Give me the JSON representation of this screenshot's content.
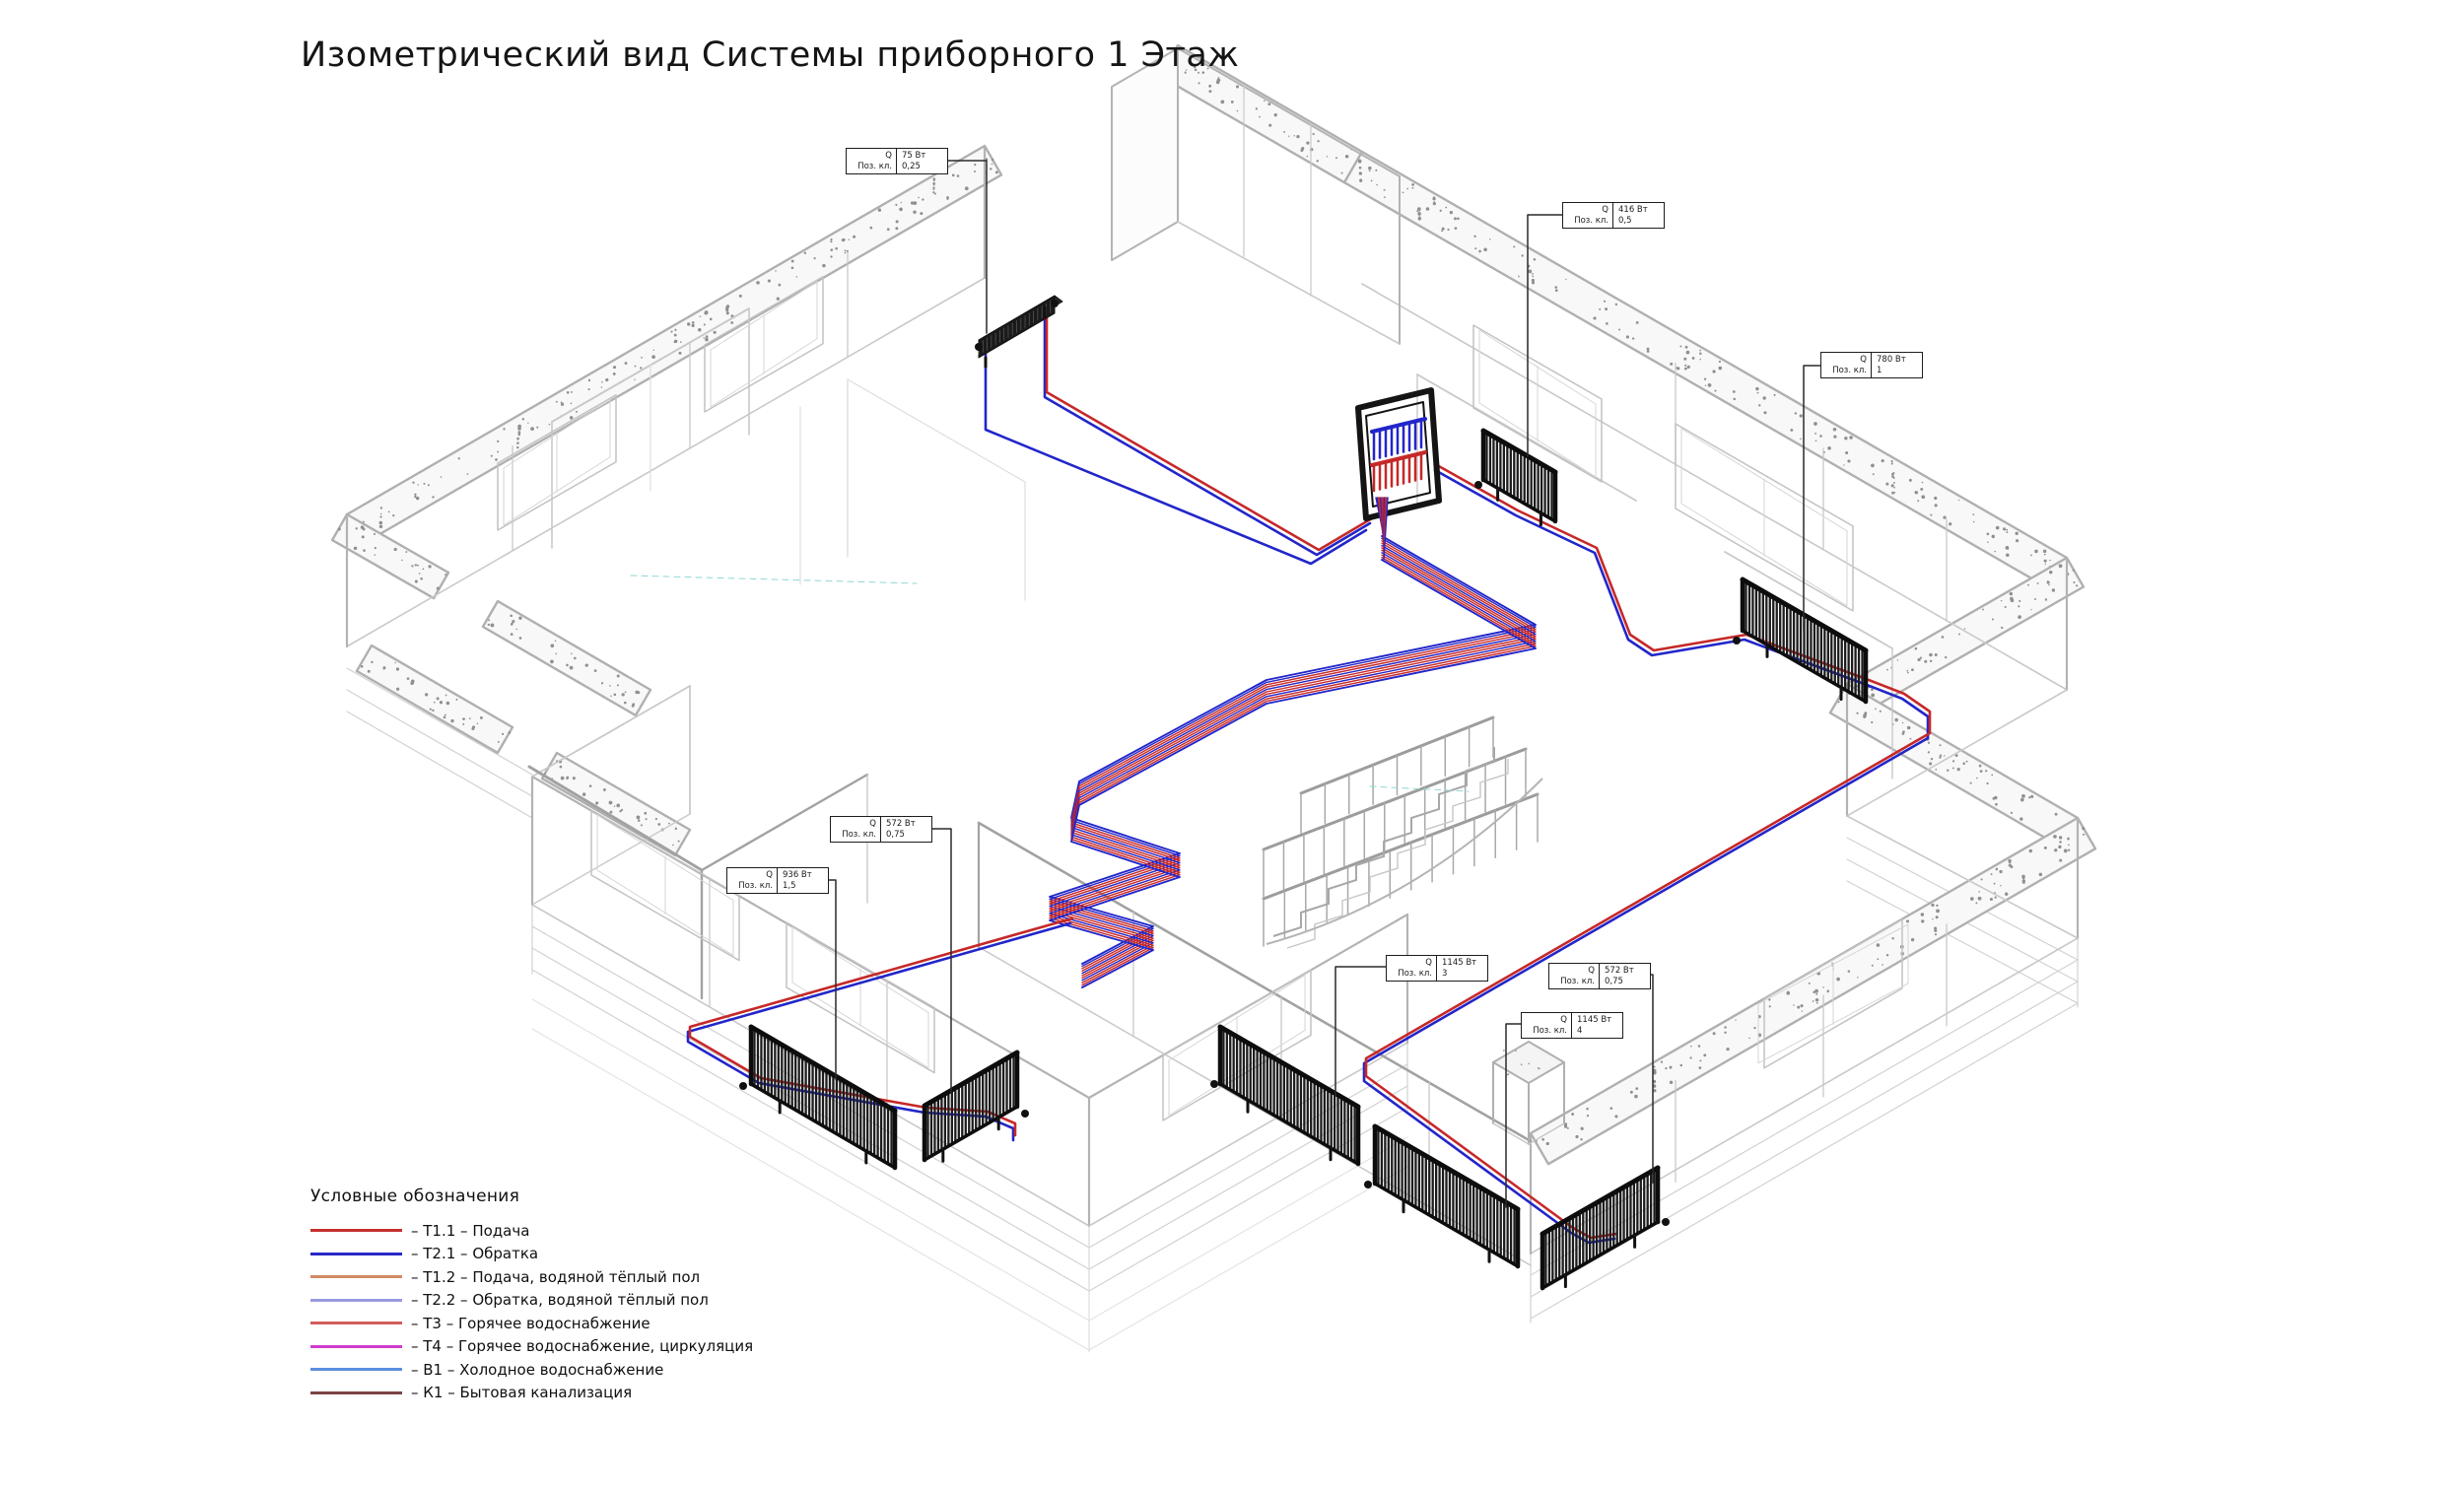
{
  "title": "Изометрический вид Системы приборного 1 Этаж",
  "legend": {
    "header": "Условные обозначения",
    "items": [
      {
        "label": "– Т1.1 – Подача",
        "color": "#c62f2f"
      },
      {
        "label": "– Т2.1 – Обратка",
        "color": "#2828c8"
      },
      {
        "label": "– Т1.2 – Подача, водяной тёплый пол",
        "color": "#d08a62"
      },
      {
        "label": "– Т2.2 – Обратка, водяной тёплый пол",
        "color": "#9a9ae0"
      },
      {
        "label": "– Т3 – Горячее водоснабжение",
        "color": "#d25c5c"
      },
      {
        "label": "– Т4 – Горячее водоснабжение, циркуляция",
        "color": "#cf3ccf"
      },
      {
        "label": "– В1 – Холодное водоснабжение",
        "color": "#5d8ede"
      },
      {
        "label": "– К1 – Бытовая канализация",
        "color": "#7c4343"
      }
    ]
  },
  "callouts": {
    "field_top": "Q",
    "field_bottom": "Поз. кл.",
    "items": [
      {
        "name": "trench-convector",
        "power": "75 Вт",
        "position": "0,25"
      },
      {
        "name": "radiator-hall",
        "power": "416 Вт",
        "position": "0,5"
      },
      {
        "name": "radiator-right",
        "power": "780 Вт",
        "position": "1"
      },
      {
        "name": "radiator-left-small",
        "power": "572 Вт",
        "position": "0,75"
      },
      {
        "name": "radiator-left-large",
        "power": "936 Вт",
        "position": "1,5"
      },
      {
        "name": "radiator-bottom-1",
        "power": "1145 Вт",
        "position": "3"
      },
      {
        "name": "radiator-corner",
        "power": "572 Вт",
        "position": "0,75"
      },
      {
        "name": "radiator-bottom-2",
        "power": "1145 Вт",
        "position": "4"
      }
    ]
  },
  "pipe_colors": {
    "supply": "#c62828",
    "return": "#2226c9"
  },
  "drawing": {
    "wall_color": "#b3b3b3",
    "radiator_color": "#161616"
  }
}
